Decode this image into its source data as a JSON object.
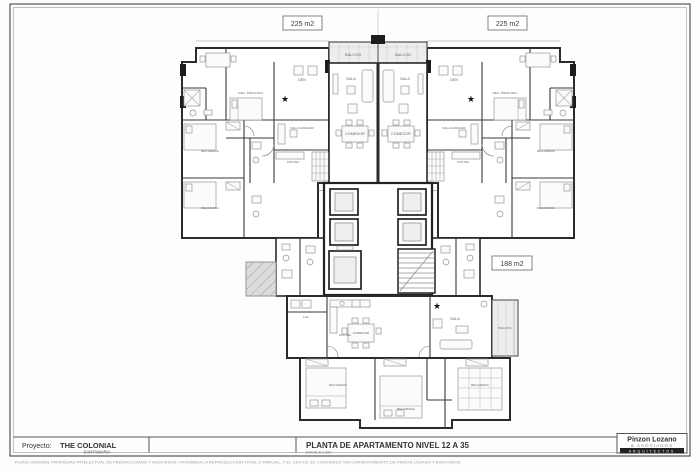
{
  "colors": {
    "ink": "#2b2b2b",
    "paper": "#ffffff",
    "fill_gray": "#ececec",
    "label_gray": "#5d5d5d"
  },
  "icons": {
    "star": "★"
  },
  "area_badges": [
    {
      "label": "225 m2"
    },
    {
      "label": "225 m2"
    },
    {
      "label": "188 m2"
    }
  ],
  "rooms": {
    "balcon_left": "BALCON",
    "balcon_right": "BALCON",
    "sala_left": "SALA",
    "sala_right": "SALA",
    "comedor_left": "COMEDOR",
    "comedor_right": "COMEDOR",
    "den_left": "DEN",
    "den_right": "DEN",
    "rec_principal_left": "REC. PRINCIPAL",
    "rec_principal_right": "REC. PRINCIPAL",
    "sala_familiar_left": "SALA FAMILIAR",
    "sala_familiar_right": "SALA FAMILIAR",
    "cocina_left": "COCINA",
    "cocina_right": "COCINA",
    "recamara_left_1": "RECAMARA",
    "recamara_left_2": "RECAMARA",
    "recamara_right_1": "RECAMARA",
    "recamara_right_2": "RECAMARA",
    "lav": "LAV",
    "cocina_bottom": "COCINA",
    "comedor_bottom": "COMEDOR",
    "sala_bottom": "SALA",
    "balcon_bottom": "BALCON",
    "recamara_bottom_1": "RECAMARA",
    "recamara_bottom_2": "RECAMARA",
    "recamara_bottom_3": "RECAMARA"
  },
  "title_block": {
    "project_label": "Proyecto:",
    "project_name": "THE COLONIAL",
    "project_subtitle": "SANTAMARIA",
    "drawing_title": "PLANTA DE APARTAMENTO  NIVEL 12 A 35",
    "scale": "ESCALA 1:100",
    "firm_name": "Pinzon Lozano",
    "firm_line2": "& ASOCIADOS",
    "firm_line3": "ARQUITECTOS",
    "disclaimer": "PLANO ORIGINAL PROPIEDAD INTELECTUAL DE PINZON LOZANO Y ASOCIADOS. PROHIBIDA LA REPRODUCCION TOTAL O PARCIAL, Y EL USO DE SU CONTENIDO SIN CONSENTIMIENTO DE PINZON LOZANO Y ASOCIADOS."
  }
}
